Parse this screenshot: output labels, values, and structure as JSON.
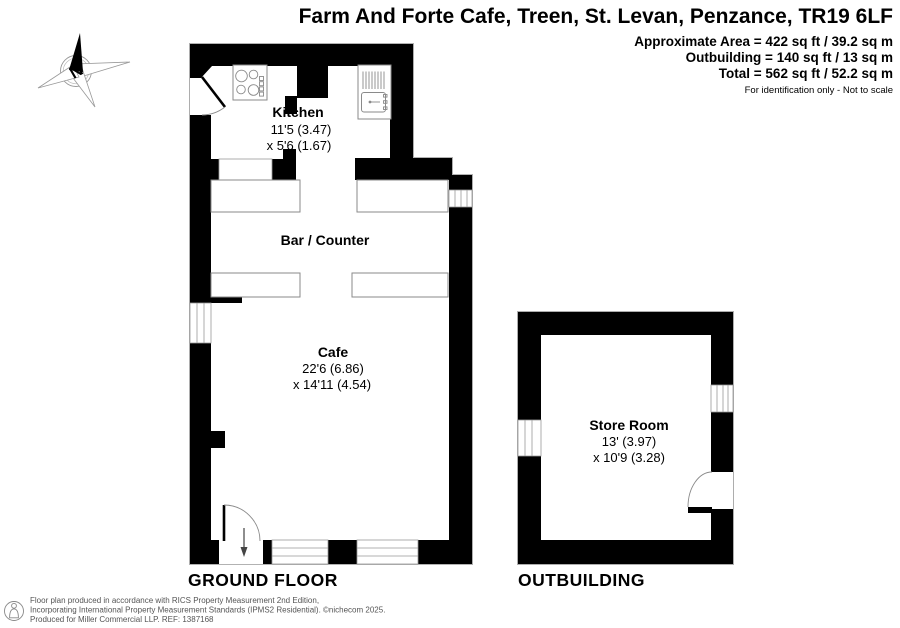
{
  "title": "Farm And Forte Cafe, Treen, St. Levan, Penzance, TR19 6LF",
  "area_summary": {
    "approximate_area": "Approximate Area = 422 sq ft / 39.2 sq m",
    "outbuilding_area": "Outbuilding = 140 sq ft / 13 sq m",
    "total_area": "Total = 562 sq ft / 52.2 sq m",
    "disclaimer": "For identification only - Not to scale"
  },
  "compass": {
    "north_label": "N"
  },
  "rooms": {
    "kitchen": {
      "name": "Kitchen",
      "dim1": "11'5 (3.47)",
      "dim2": "x 5'6 (1.67)"
    },
    "bar": {
      "name": "Bar / Counter"
    },
    "cafe": {
      "name": "Cafe",
      "dim1": "22'6 (6.86)",
      "dim2": "x 14'11 (4.54)"
    },
    "store_room": {
      "name": "Store Room",
      "dim1": "13' (3.97)",
      "dim2": "x 10'9 (3.28)"
    }
  },
  "floor_labels": {
    "ground": "GROUND FLOOR",
    "outbuilding": "OUTBUILDING"
  },
  "footer": {
    "line1": "Floor plan produced in accordance with RICS Property Measurement 2nd Edition,",
    "line2": "Incorporating International Property Measurement Standards (IPMS2 Residential).    ©nichecom 2025.",
    "line3": "Produced for Miller Commercial LLP.     REF:     1387168"
  },
  "colors": {
    "wall": "#000000",
    "outline": "#999999",
    "footer_text": "#555555"
  }
}
